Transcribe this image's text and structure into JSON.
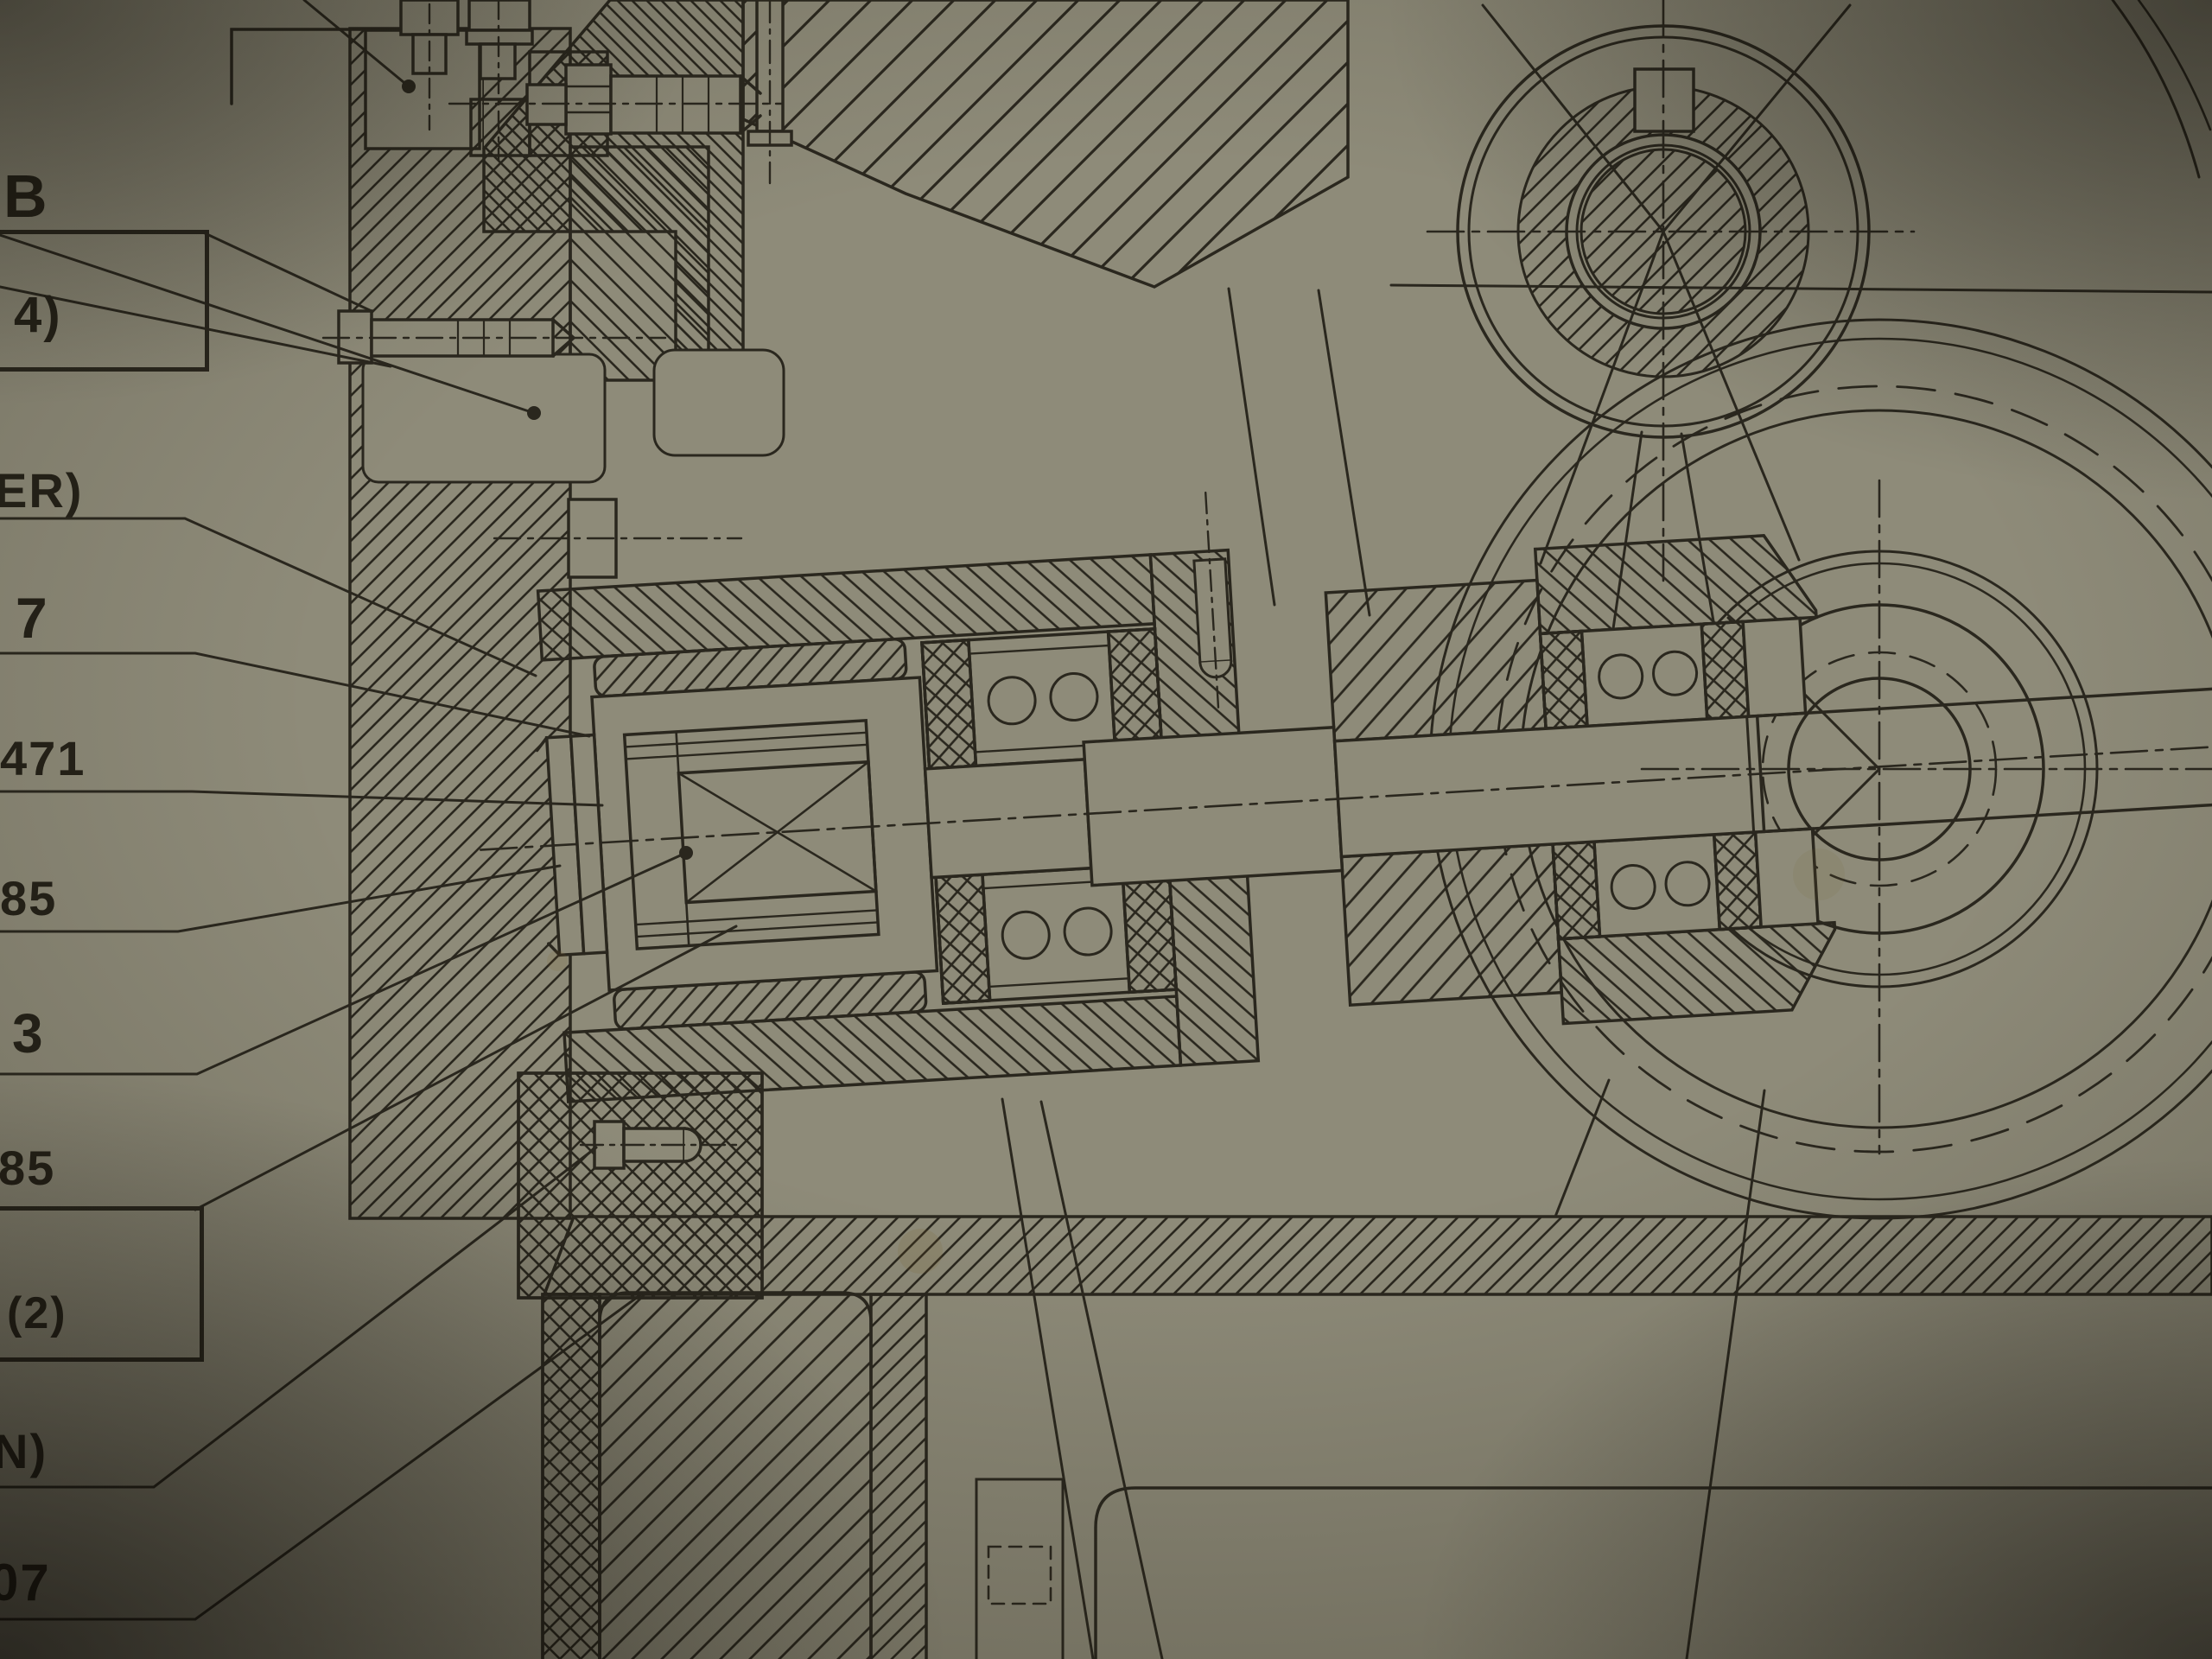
{
  "photo": {
    "paper_color": "#93917f",
    "ink_color": "#27251e",
    "subject": "sectioned gearbox shaft assembly drawing"
  },
  "labels": {
    "items": [
      {
        "id": "b",
        "text": "B"
      },
      {
        "id": "b-qty",
        "text": "4)"
      },
      {
        "id": "er",
        "text": "ER)"
      },
      {
        "id": "n7",
        "text": "7"
      },
      {
        "id": "n471",
        "text": "471"
      },
      {
        "id": "n85a",
        "text": "85"
      },
      {
        "id": "n3",
        "text": "3"
      },
      {
        "id": "n85b",
        "text": "85"
      },
      {
        "id": "qty2",
        "text": "(2)"
      },
      {
        "id": "nn",
        "text": "N)"
      },
      {
        "id": "n07",
        "text": "07"
      }
    ]
  }
}
